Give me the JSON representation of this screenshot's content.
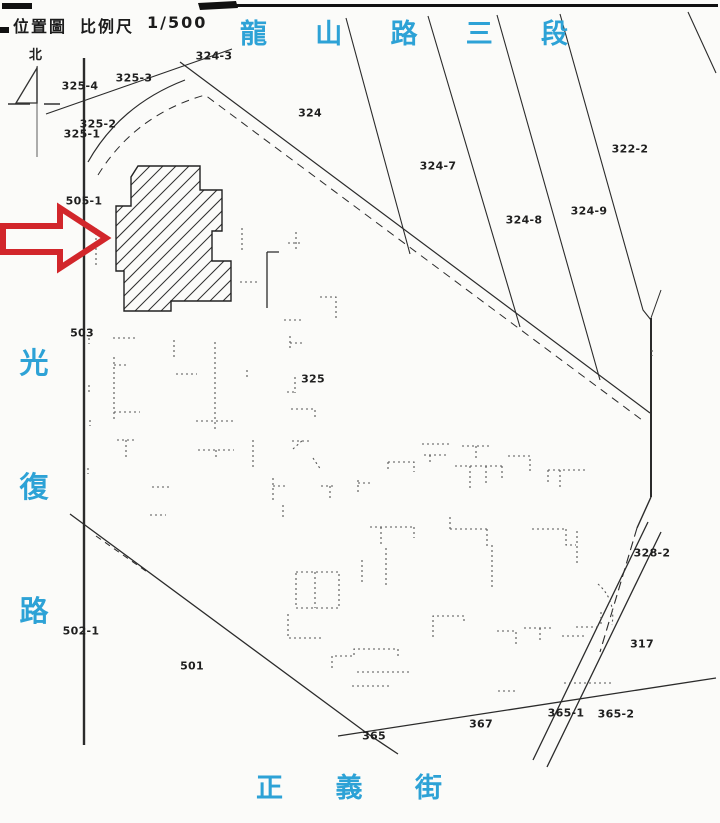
{
  "header": {
    "map_type": "位置圖",
    "scale_label": "比例尺",
    "scale_value": "1/500"
  },
  "north": {
    "label": "北"
  },
  "streets": {
    "top": {
      "name": "龍山路三段",
      "chars": [
        "龍",
        "山",
        "路",
        "三",
        "段"
      ]
    },
    "left": {
      "name": "光復路",
      "chars": [
        "光",
        "復",
        "路"
      ]
    },
    "bottom": {
      "name": "正義街",
      "chars": [
        "正",
        "義",
        "街"
      ]
    }
  },
  "parcels": [
    {
      "id": "325-4",
      "x": 80,
      "y": 86
    },
    {
      "id": "325-3",
      "x": 134,
      "y": 78
    },
    {
      "id": "324-3",
      "x": 214,
      "y": 56
    },
    {
      "id": "325-2",
      "x": 98,
      "y": 124
    },
    {
      "id": "325-1",
      "x": 82,
      "y": 134
    },
    {
      "id": "505-1",
      "x": 84,
      "y": 201
    },
    {
      "id": "503",
      "x": 82,
      "y": 333
    },
    {
      "id": "502-1",
      "x": 81,
      "y": 631
    },
    {
      "id": "501",
      "x": 192,
      "y": 666
    },
    {
      "id": "324",
      "x": 310,
      "y": 113
    },
    {
      "id": "324-7",
      "x": 438,
      "y": 166
    },
    {
      "id": "324-8",
      "x": 524,
      "y": 220
    },
    {
      "id": "324-9",
      "x": 589,
      "y": 211
    },
    {
      "id": "322-2",
      "x": 630,
      "y": 149
    },
    {
      "id": "325",
      "x": 313,
      "y": 379
    },
    {
      "id": "328-2",
      "x": 652,
      "y": 553
    },
    {
      "id": "317",
      "x": 642,
      "y": 644
    },
    {
      "id": "367",
      "x": 481,
      "y": 724
    },
    {
      "id": "365",
      "x": 374,
      "y": 736
    },
    {
      "id": "365-1",
      "x": 566,
      "y": 713
    },
    {
      "id": "365-2",
      "x": 616,
      "y": 714
    }
  ],
  "colors": {
    "street_text": "#2da2d6",
    "arrow_red": "#d2262b",
    "map_line": "#2b2b2b",
    "faint_line": "#555555"
  }
}
